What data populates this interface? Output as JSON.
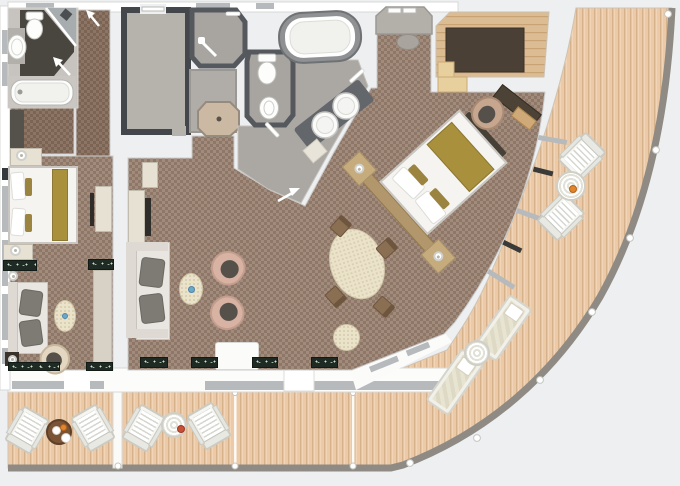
{
  "document": {
    "type": "floor-plan",
    "subject": "cruise-ship-suite-with-curved-veranda",
    "visible_text": "none"
  },
  "colors": {
    "bg": "#edeff0",
    "wall": "#ffffff",
    "wall-line": "#d2d2d0",
    "carpet-base": "#a08b7d",
    "carpet-check": "#8f7767",
    "hall-base": "#8d7566",
    "hall-check": "#7c6454",
    "deck-base": "#edcaa7",
    "deck-stripe": "#d6b28c",
    "deck-hi": "#f6dcc0",
    "railing": "#8f8b84",
    "wood-floor": "#dcbc92",
    "wood-line": "#c8a376",
    "closet-rug": "#4a4035",
    "dark-wall": "#43464a",
    "bath-wall": "#55585c",
    "bath-floor": "#aba7a2",
    "bath-dark": "#49463f",
    "fixture": "#fdfdfc",
    "counter": "#63666a",
    "gold": "#a8903d",
    "sofa": "#e9e6e1",
    "cushion": "#7c7973",
    "blush": "#d8b2a2",
    "cushion-dark": "#56504a",
    "cream-table": "#ebe2ca",
    "marble": "#1f2a24",
    "sill": "#b6babc"
  },
  "rooms": [
    "secondary-bathroom",
    "wardrobe-closet",
    "corridor",
    "entry-foyer-room",
    "shower-room",
    "utility-room",
    "wc-room",
    "master-bathroom",
    "entry-alcove",
    "walk-in-closet",
    "master-bedroom",
    "dining-area",
    "living-room",
    "second-bedroom",
    "balcony-left",
    "balcony-middle",
    "curved-veranda"
  ],
  "fixtures": [
    "bathtub",
    "large-oval-bathtub",
    "double-vanity-sinks",
    "toilet",
    "bidet",
    "corner-shower",
    "shower-tray",
    "wash-basin",
    "door-swing-arrows",
    "towel-bars"
  ],
  "furniture": [
    "master-bed",
    "guest-bed",
    "dining-table",
    "dining-chairs",
    "sofa",
    "guest-sofa",
    "armchairs",
    "coffee-table",
    "desk",
    "desk-chair",
    "tv-cabinet",
    "dresser",
    "nightstands",
    "marble-consoles",
    "ottoman-pouf",
    "closet-bench"
  ],
  "deck": {
    "chair_sets": 3,
    "chairs_per_set": 2,
    "round_tables": 4,
    "sun_loungers": 2,
    "glass_dividers": 3,
    "stanchions": 12
  }
}
